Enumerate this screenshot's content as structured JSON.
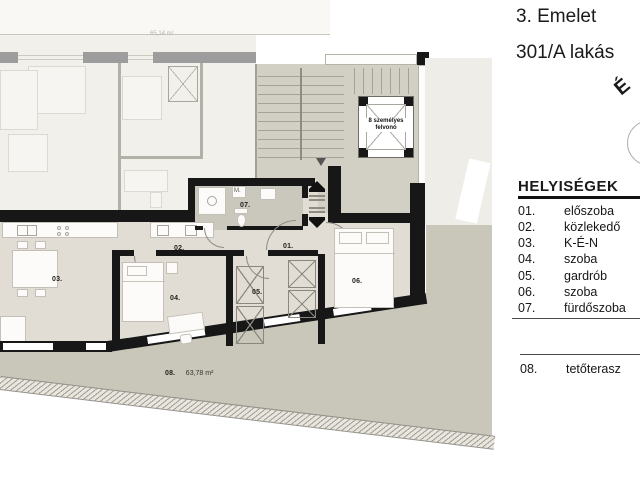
{
  "header": {
    "floor_title": "3. Emelet",
    "apartment_title": "301/A lakás",
    "north_label": "É"
  },
  "legend": {
    "heading": "HELYISÉGEK",
    "items": [
      {
        "num": "01.",
        "name": "előszoba"
      },
      {
        "num": "02.",
        "name": "közlekedő"
      },
      {
        "num": "03.",
        "name": "K-É-N"
      },
      {
        "num": "04.",
        "name": "szoba"
      },
      {
        "num": "05.",
        "name": "gardrób"
      },
      {
        "num": "06.",
        "name": "szoba"
      },
      {
        "num": "07.",
        "name": "fürdőszoba"
      }
    ],
    "terrace_item": {
      "num": "08.",
      "name": "tetőterasz"
    }
  },
  "plan": {
    "neighbor_area": "65,14 m²",
    "elevator_label": "8 személyes felvonó",
    "washer_label": "M.",
    "labels": {
      "r01": "01.",
      "r02": "02.",
      "r03": "03.",
      "r04": "04.",
      "r05": "05.",
      "r06": "06.",
      "r07": "07."
    },
    "terrace": {
      "num": "08.",
      "area": "63,78 m²"
    }
  },
  "colors": {
    "apartment_floor": "#e1ddd5",
    "neighbor_floor": "#f2f0eb",
    "stair_floor": "#d2cfc4",
    "bathroom_floor": "#cac7bd",
    "terrace": "#c9c6ba",
    "wall_black": "#171717",
    "wall_gray": "#9d9d9d"
  }
}
